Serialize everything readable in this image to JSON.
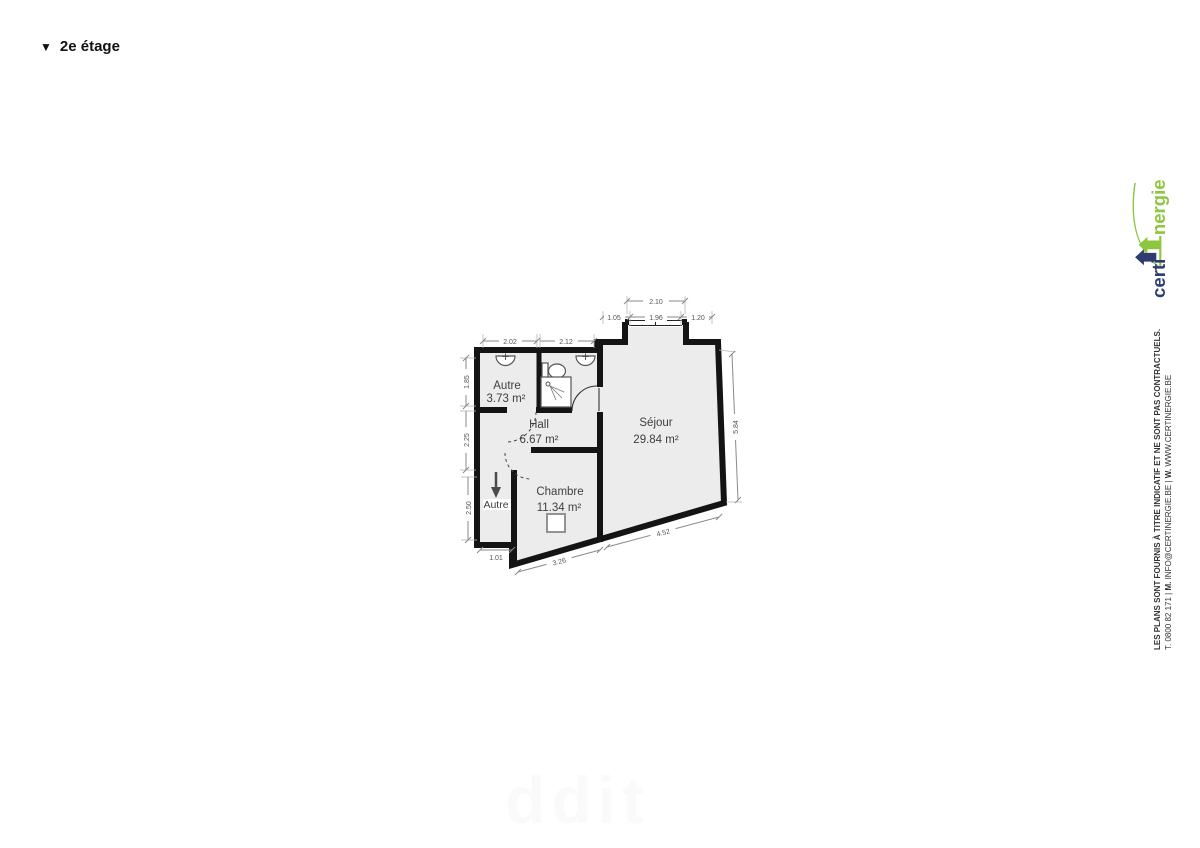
{
  "title": {
    "marker": "▼",
    "text": "2e étage"
  },
  "rooms": {
    "autre": {
      "name": "Autre",
      "area": "3.73 m²"
    },
    "hall": {
      "name": "Hall",
      "area": "6.67 m²"
    },
    "sejour": {
      "name": "Séjour",
      "area": "29.84 m²"
    },
    "chambre": {
      "name": "Chambre",
      "area": "11.34 m²"
    },
    "stairs": {
      "name": "Autre"
    }
  },
  "dims": {
    "top_overall": "2.10",
    "top_left": "1.05",
    "top_window": "1.96",
    "top_right": "1.20",
    "autre_width": "2.02",
    "bath_width": "2.12",
    "left_top": "1.85",
    "left_mid": "2.25",
    "left_bottom": "2.50",
    "stairs_width": "1.01",
    "chambre_bottom": "3.26",
    "sejour_bottom": "4.52",
    "right_side": "5.84"
  },
  "branding": {
    "certi": "certi",
    "nergie": "nergie"
  },
  "legal": {
    "disclaimer": "LES PLANS SONT FOURNIS À TITRE INDICATIF ET NE SONT PAS CONTRACTUELS.",
    "contact_t": "T. 0800 82 171 | ",
    "contact_m_label": "M.",
    "contact_m": " INFO@CERTINERGIE.BE | ",
    "contact_w_label": "W.",
    "contact_w": " WWW.CERTINERGIE.BE"
  },
  "watermark": "ddit",
  "colors": {
    "brand_navy": "#2e3d6e",
    "brand_green": "#8dc63f",
    "wall": "#141414",
    "room_fill": "#ececec"
  }
}
